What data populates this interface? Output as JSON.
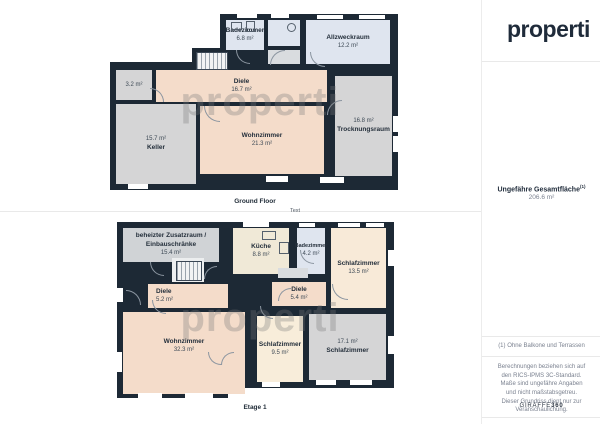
{
  "brand": {
    "logo": "properti",
    "watermark": "properti",
    "credit_name": "GIRAFFE",
    "credit_suffix": "360"
  },
  "panel": {
    "total_area_label": "Ungefähre Gesamtfläche",
    "total_area_sup": "(1)",
    "total_area_value": "206.6 m²",
    "footnote": "(1) Ohne Balkone und Terrassen",
    "disclaimer": "Berechnungen beziehen sich auf den RICS-IPMS 3C-Standard. Maße sind ungefähre Angaben und nicht maßstabsgetreu. Dieser Grundriss dient nur zur Veranschaulichung."
  },
  "floors": [
    {
      "title": "Ground Floor",
      "rooms": {
        "badezimmer": {
          "name": "Badezimmer",
          "area": "6.8 m²"
        },
        "allzweckraum": {
          "name": "Allzweckraum",
          "area": "12.2 m²"
        },
        "diele": {
          "name": "Diele",
          "area": "16.7 m²"
        },
        "storage": {
          "area": "3.2 m²"
        },
        "keller": {
          "name": "Keller",
          "area": "15.7 m²"
        },
        "wohnzimmer": {
          "name": "Wohnzimmer",
          "area": "21.3 m²"
        },
        "trocknungsraum": {
          "name": "Trocknungsraum",
          "area": "16.8 m²"
        }
      }
    },
    {
      "title": "Etage 1",
      "note": "Text",
      "rooms": {
        "zusatzraum": {
          "name": "beheizter Zusatzraum / Einbauschränke",
          "area": "15.4 m²"
        },
        "kueche": {
          "name": "Küche",
          "area": "8.8 m²"
        },
        "badezimmer": {
          "name": "Badezimmer",
          "area": "4.2 m²"
        },
        "schlafzimmer_1": {
          "name": "Schlafzimmer",
          "area": "13.5 m²"
        },
        "diele_links": {
          "name": "Diele",
          "area": "5.2 m²"
        },
        "diele_rechts": {
          "name": "Diele",
          "area": "5.4 m²"
        },
        "wohnzimmer": {
          "name": "Wohnzimmer",
          "area": "32.3 m²"
        },
        "schlafzimmer_2": {
          "name": "Schlafzimmer",
          "area": "9.5 m²"
        },
        "schlafzimmer_3": {
          "name": "Schlafzimmer",
          "area": "17.1 m²"
        }
      }
    }
  ],
  "colors": {
    "wall": "#1d2935",
    "room_living": "#f4dcca",
    "room_utility": "#d5d5d6",
    "room_bath": "#dfe5ef",
    "room_kitchen": "#f0e9d7",
    "room_bedroom": "#f8ead8",
    "logo": "#1f2b3a"
  }
}
